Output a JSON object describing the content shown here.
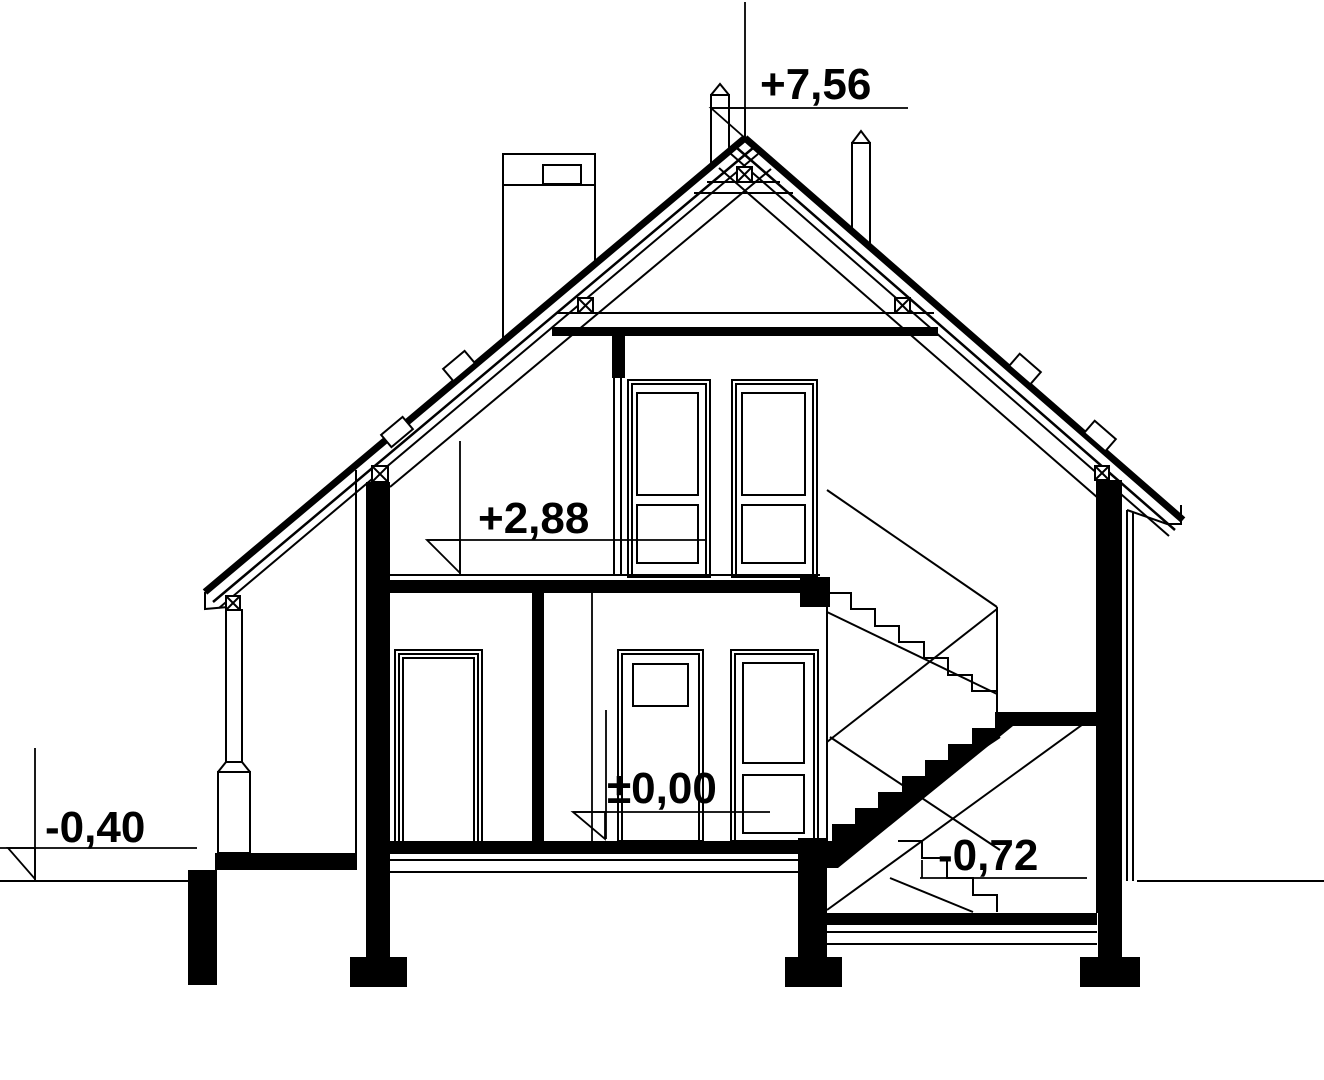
{
  "drawing": {
    "kind": "house-cross-section",
    "colors": {
      "line": "#000000",
      "background": "#ffffff"
    },
    "levels": {
      "ridge": "+7,56",
      "upper_floor": "+2,88",
      "ground_floor": "±0,00",
      "grade": "-0,40",
      "lower_landing": "-0,72"
    }
  }
}
